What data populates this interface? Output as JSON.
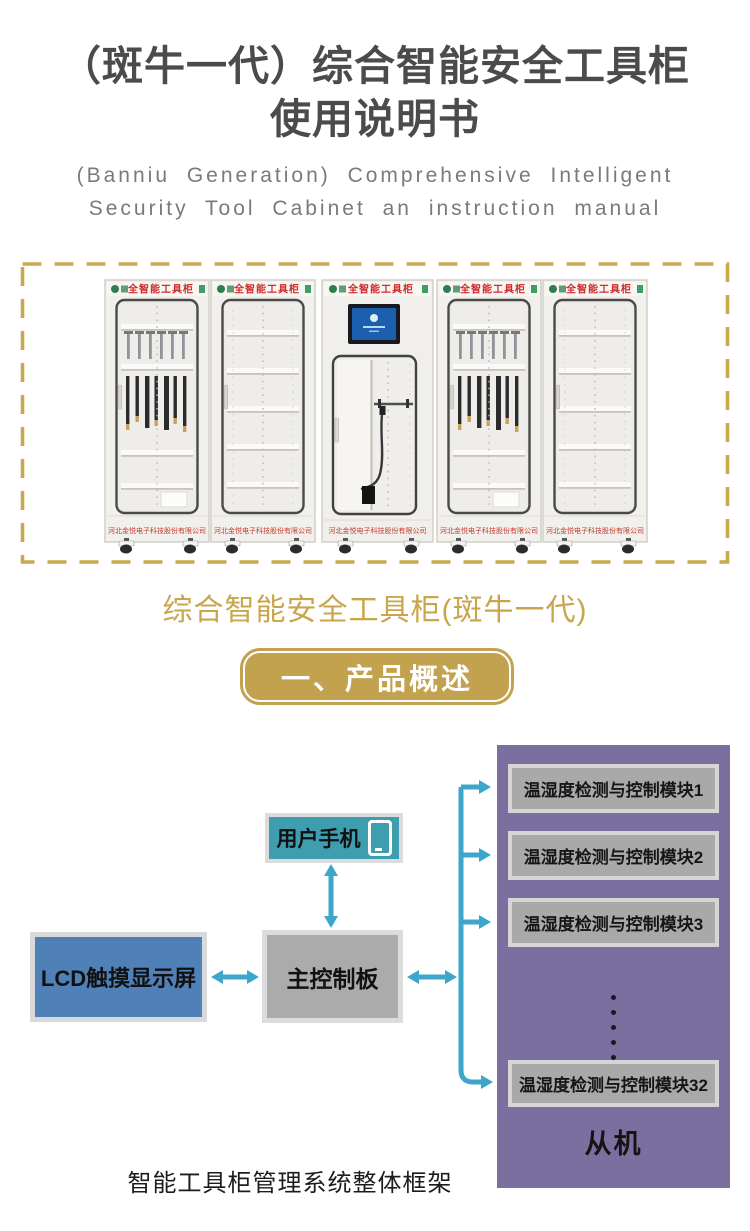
{
  "header": {
    "title_line1": "（斑牛一代）综合智能安全工具柜",
    "title_line2": "使用说明书",
    "subtitle_line1": "(Banniu Generation) Comprehensive Intelligent",
    "subtitle_line2": "Security Tool Cabinet an instruction manual"
  },
  "product_figure": {
    "cabinet_header_label": "全智能工具柜",
    "cabinet_footer_label": "河北金悦电子科技股份有限公司",
    "caption": "综合智能安全工具柜(斑牛一代)"
  },
  "section": {
    "banner_label": "一、产品概述"
  },
  "diagram": {
    "phone_label": "用户手机",
    "lcd_label": "LCD触摸显示屏",
    "main_board_label": "主控制板",
    "slave_label": "从机",
    "modules": [
      "温湿度检测与控制模块1",
      "温湿度检测与控制模块2",
      "温湿度检测与控制模块3",
      "温湿度检测与控制模块32"
    ],
    "caption": "智能工具柜管理系统整体框架",
    "icons": {
      "phone": "smartphone-outline"
    },
    "colors": {
      "arrow": "#3ea6cb",
      "phone_box": "#3f9db0",
      "lcd_box": "#5080b8",
      "board_box": "#ababab",
      "module_box": "#a9a9a9",
      "panel": "#7b6fa0",
      "gold": "#c9a64c",
      "title_gray": "#4b4b4b",
      "cabinet_text_red": "#cf2b2b"
    }
  }
}
